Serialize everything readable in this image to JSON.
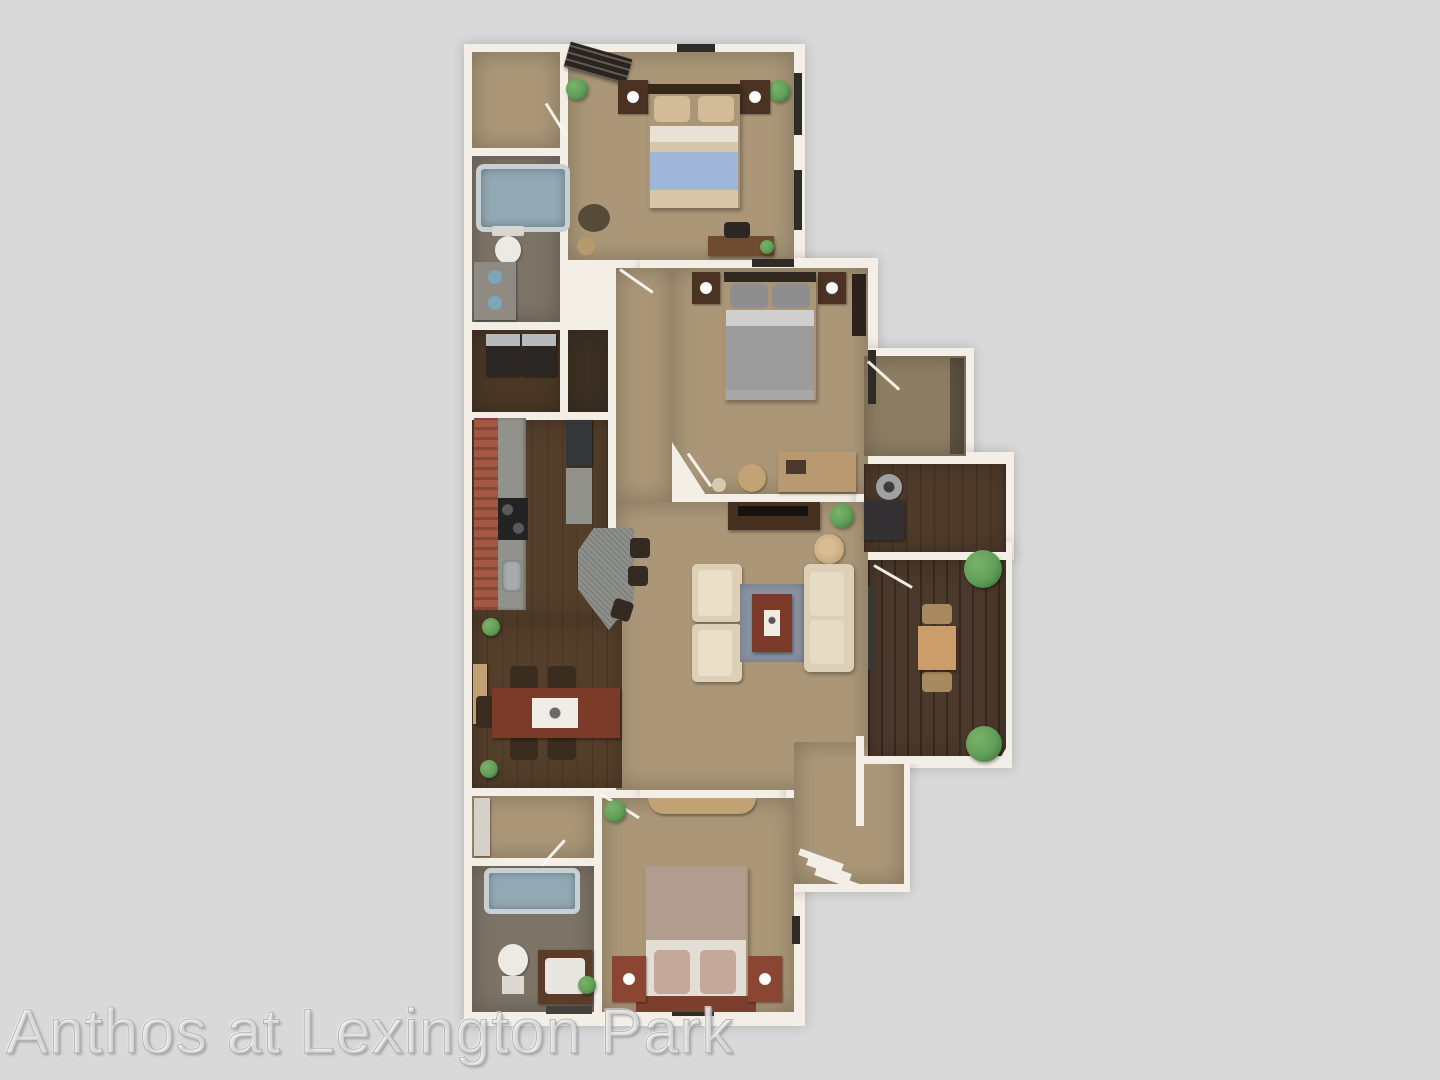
{
  "watermark": {
    "text": "Anthos at Lexington Park"
  },
  "palette": {
    "bg": "#d9d9d9",
    "wall": "#f3efe6",
    "carpet": "#ab9778",
    "carpet-dark": "#8d7e63",
    "wood": "#543f2b",
    "wood-office": "#4f3b2a",
    "wood-patio": "#4b392b",
    "bath-floor": "#7d7468",
    "laundry-floor": "#4b3726",
    "closet-floor": "#3d3124",
    "cabinet-red": "#a25842",
    "counter-gray": "#90928b",
    "granite": "#8d8f8a",
    "bed-blue": "#9fb6d8",
    "bed-sheet": "#d7c6a8",
    "bed-gray": "#9c9c9c",
    "bed-mauve": "#b19c90",
    "headboard-red": "#7c3e2d",
    "nightstand": "#4a3322",
    "nightstand-red": "#8a4632",
    "cream": "#ddd0b6",
    "rug-blue": "#8a93a1",
    "coffee-table": "#7c3b28",
    "tv-console": "#46301f",
    "tan-furniture": "#c0a274",
    "plant-green": "#5f9e57",
    "appliance-dark": "#2e2a26",
    "tub-rim": "#c8d0d4",
    "tub-inner": "#92a9b4",
    "fixture-white": "#eceae2",
    "watermark": "rgba(238,238,238,0.55)"
  }
}
